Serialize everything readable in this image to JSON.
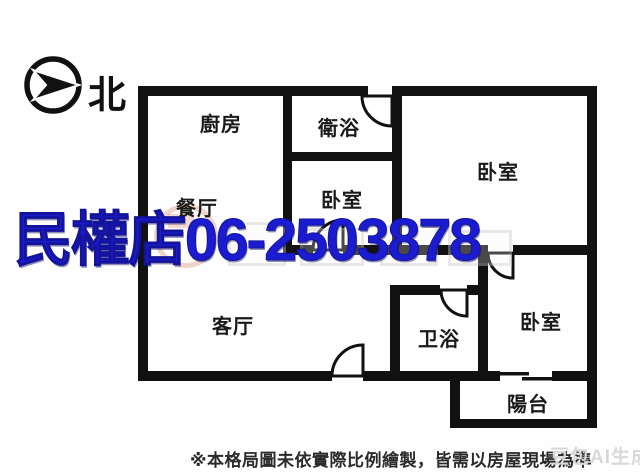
{
  "compass": {
    "north_label": "北"
  },
  "watermark": {
    "store_phone": "民權店06-2503878",
    "color": "#1b1bd1"
  },
  "rooms": {
    "kitchen": "廚房",
    "bath_top": "衛浴",
    "bedroom_top_right": "卧室",
    "dining": "餐厅",
    "bedroom_middle": "卧室",
    "living": "客厅",
    "bath_bottom": "卫浴",
    "bedroom_bottom_right": "卧室",
    "balcony": "陽台"
  },
  "footer": {
    "disclaimer": "※本格局圖未依實際比例繪製，皆需以房屋現場為準",
    "ai_watermark": "豆包AI生成"
  },
  "colors": {
    "wall": "#111111",
    "watermark_blue": "#1b1bd1",
    "label": "#1a1a1a",
    "ai_watermark_gray": "#d8d8d8"
  }
}
